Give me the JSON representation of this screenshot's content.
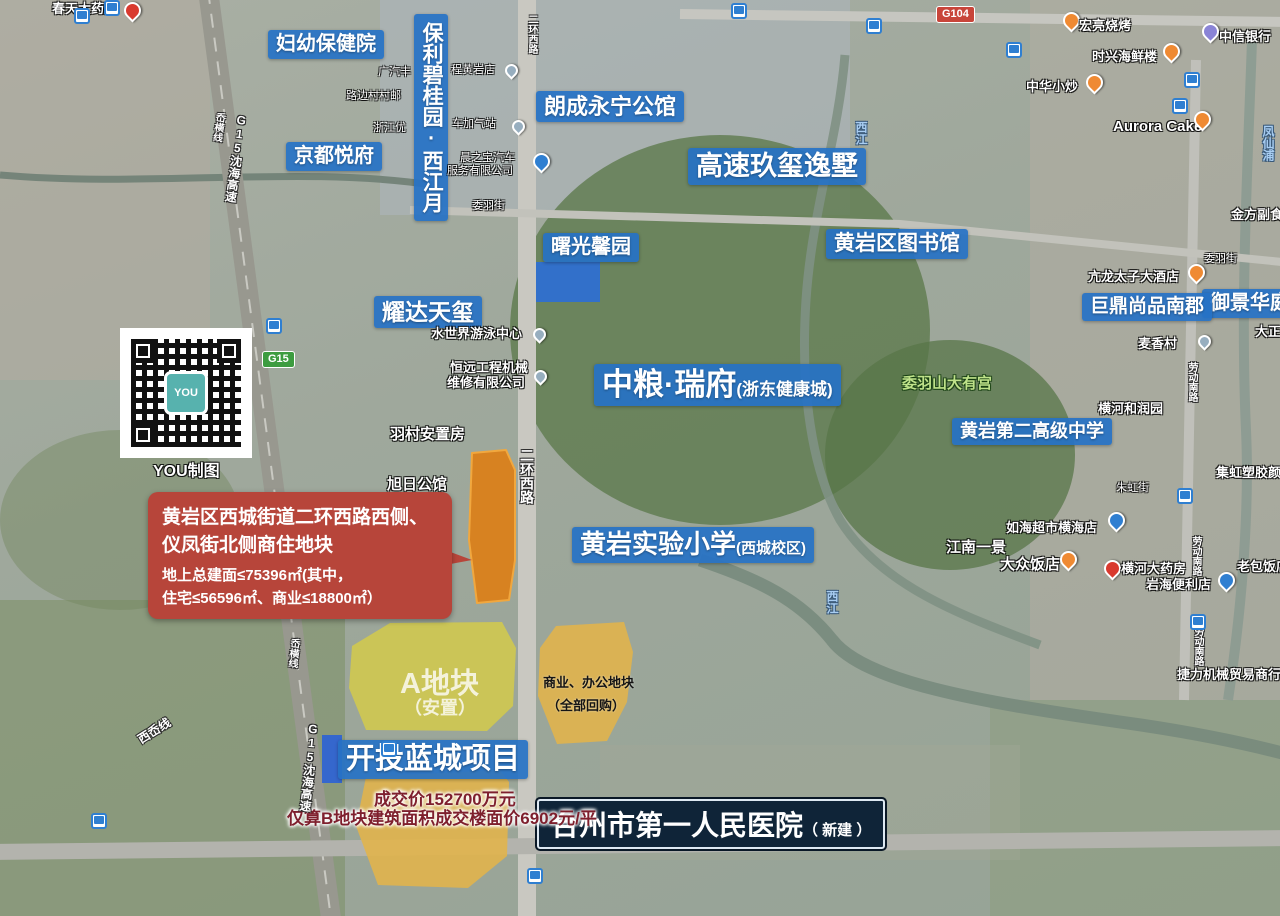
{
  "colors": {
    "label_blue": "#2672c5",
    "callout_red": "#b7453a",
    "hospital_navy": "#0f2438",
    "subject_parcel_orange": "#d9811e",
    "parcel_a_yellow": "#d5cc48",
    "parcel_biz_yellow": "#e2b44a",
    "price_text_maroon": "#7e1f2d",
    "g15_badge_green": "#3d9c40",
    "g104_badge_red": "#c8453a"
  },
  "projects": {
    "fuyou": "妇幼保健院",
    "baoli": "保利碧桂园·西江月",
    "langcheng": "朗成永宁公馆",
    "gaosu": "高速玖玺逸墅",
    "jingdu": "京都悦府",
    "shuguang": "曙光馨园",
    "library": "黄岩区图书馆",
    "yaoda": "耀达天玺",
    "zhongliang_main": "中粮·瑞府",
    "zhongliang_sub": "(浙东健康城)",
    "no2school": "黄岩第二高级中学",
    "primary_main": "黄岩实验小学",
    "primary_sub": "(西城校区)",
    "kaitou": "开投蓝城项目",
    "yujing": "御景华庭",
    "juding": "巨鼎尚品南郡",
    "hospital_main": "台州市第一人民医院",
    "hospital_sub": "（ 新建 ）"
  },
  "callout": {
    "line1": "黄岩区西城街道二环西路西侧、",
    "line2": "仪凤街北侧商住地块",
    "line3": "地上总建面≤75396㎡(其中，",
    "line4": "住宅≤56596㎡、商业≤18800㎡）"
  },
  "parcels": {
    "a_label": "A地块",
    "a_sub": "（安置）",
    "biz_label": "商业、办公地块",
    "biz_sub": "（全部回购）",
    "price1": "成交价152700万元",
    "price2": "仅算B地块建筑面积成交楼面价6902元/平"
  },
  "pois": {
    "chuntian": "春天大药房",
    "guangqi": "广汽丰",
    "lubian": "路边村村邮",
    "zhejiangyou": "浙江优",
    "chenghuangyan": "程黄岩店",
    "jiaqizhan": "车加气站",
    "chenzhibao1": "晨之宝汽车",
    "chenzhibao2": "服务有限公司",
    "weiyujie": "委羽街",
    "shuishijie": "水世界游泳中心",
    "hengyuan1": "恒远工程机械",
    "hengyuan2": "维修有限公司",
    "yucun": "羽村安置房",
    "xuri": "旭日公馆",
    "weiyushan": "委羽山大有宫",
    "heyuan": "横河和润园",
    "jihong": "集虹塑胶颜料",
    "zhuhong": "朱虹街",
    "ruhai": "如海超市横海店",
    "jiangnan": "江南一景",
    "dazhong": "大众饭店",
    "hengheyaofang": "横河大药房",
    "yanhai": "岩海便利店",
    "laobao": "老包饭店",
    "jieli": "捷力机械贸易商行",
    "hongliang": "宏亮烧烤",
    "shixing": "时兴海鲜楼",
    "zhongxin": "中信银行",
    "zhonghua": "中华小炒",
    "aurora": "Aurora Cake",
    "jinfang": "金方副食",
    "kanglong": "亢龙太子大酒店",
    "dazheng": "大正",
    "maixiang": "麦香村"
  },
  "roads": {
    "g15_expwy": "G15沈海高速",
    "aoheng": "岙横线",
    "xiao": "西岙线",
    "erhuan": "二环西路",
    "laodong": "劳动南路"
  },
  "rivers": {
    "xijiang": "西江",
    "fengxianpu": "凤仙浦"
  },
  "badges": {
    "g15": "G15",
    "g104": "G104"
  },
  "watermark": {
    "qr_logo": "YOU",
    "qr_caption": "YOU制图"
  }
}
